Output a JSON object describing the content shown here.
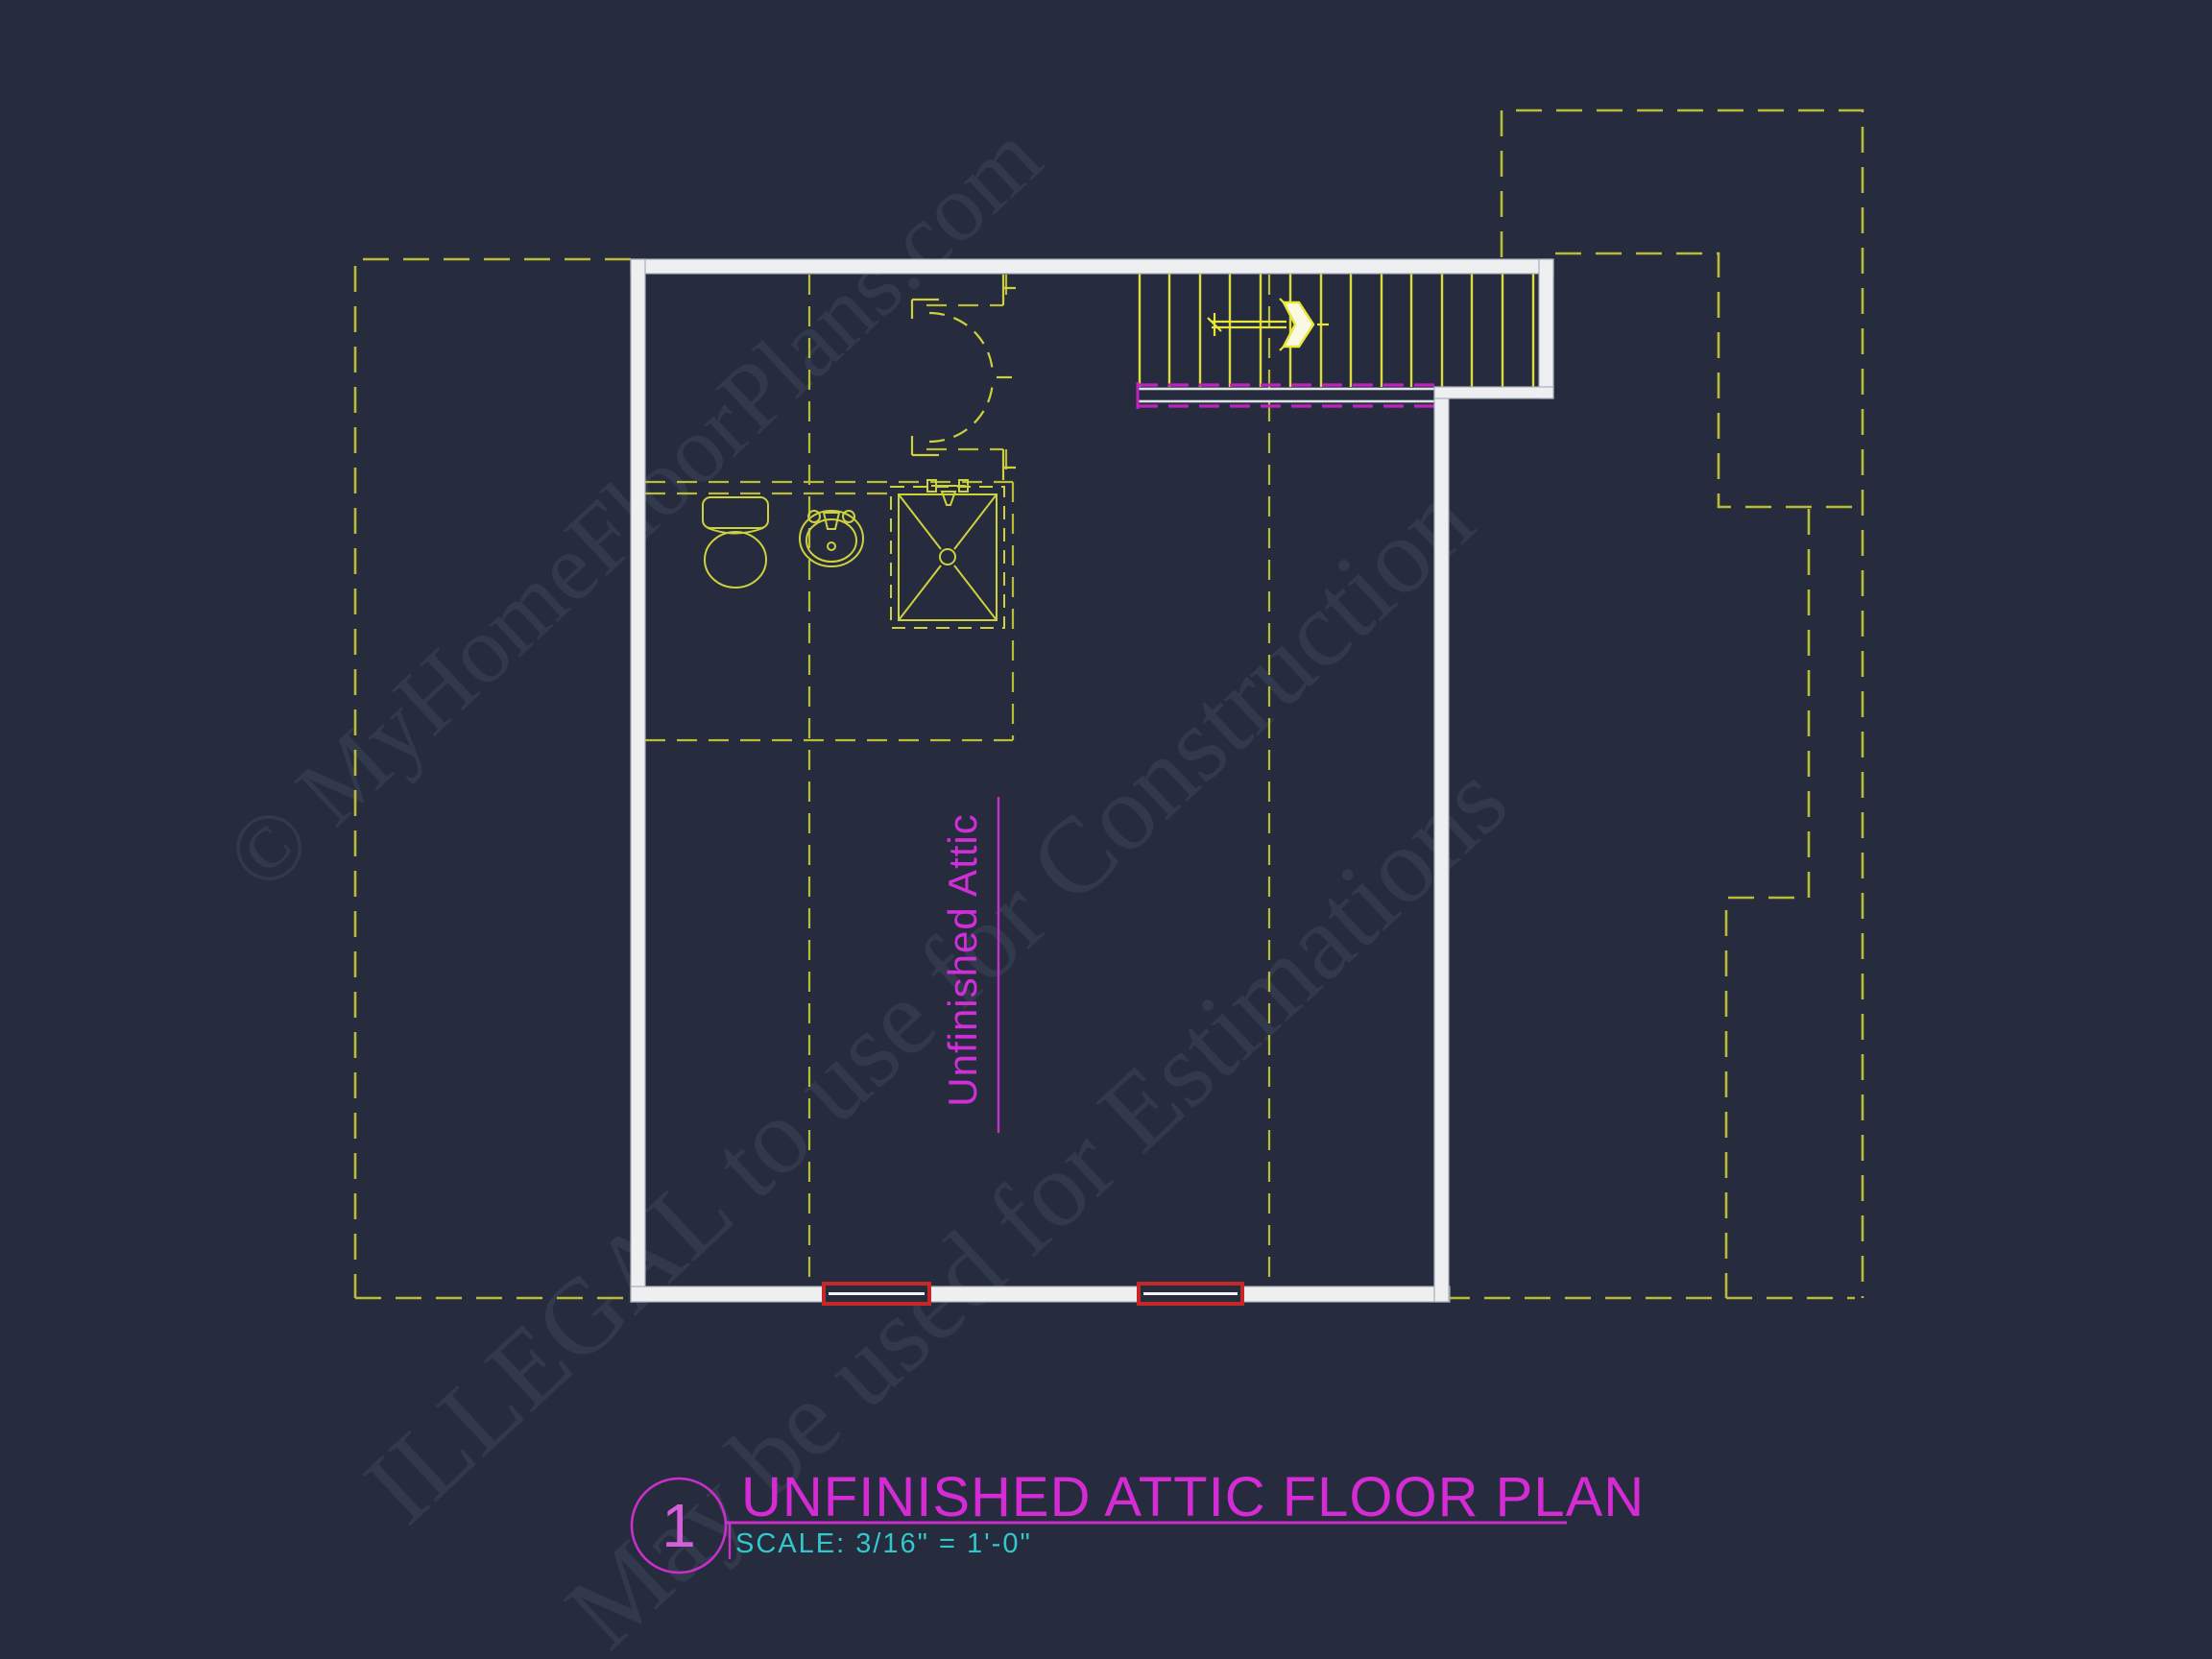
{
  "page": {
    "background_color": "#262b3e"
  },
  "watermark": {
    "color": "#39405c",
    "line1": "© MyHomeFloorPlans.com",
    "line2": "ILLEGAL to use for Construction",
    "line3": "May be used for Estimations"
  },
  "plan": {
    "room_label": "Unfinished Attic",
    "colors": {
      "roof_outline_dash_yellow": "#b9bd35",
      "fixture_yellow": "#cdd23c",
      "stair_tread_yellow": "#dcdc3a",
      "wall_white": "#edeff1",
      "railing_magenta": "#bf23bf",
      "window_red": "#c62828",
      "arrow_fill": "#fbf9e4",
      "label_magenta": "#d02fd8"
    }
  },
  "title_block": {
    "detail_number": "1",
    "title": "UNFINISHED ATTIC FLOOR PLAN",
    "scale_label": "SCALE: 3/16\" = 1'-0\"",
    "accent_color": "#c92fc9",
    "scale_text_color": "#2fc9cd"
  }
}
